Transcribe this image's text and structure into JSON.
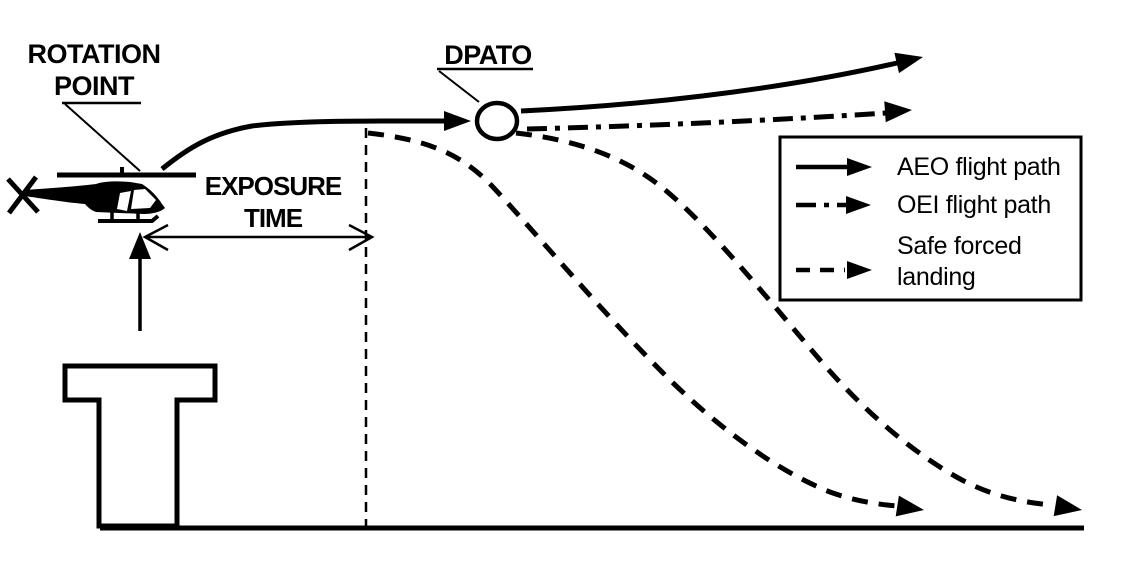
{
  "diagram_labels": {
    "rotation_point_line1": "ROTATION",
    "rotation_point_line2": "POINT",
    "dpato": "DPATO",
    "exposure_line1": "EXPOSURE",
    "exposure_line2": "TIME"
  },
  "legend": {
    "items": [
      {
        "label": "AEO flight path",
        "line_style": "solid-arrow"
      },
      {
        "label": "OEI flight path",
        "line_style": "dash-dot-arrow"
      },
      {
        "label": "Safe forced landing",
        "line_style": "dashed-arrow"
      }
    ]
  },
  "colors": {
    "ink": "#000000",
    "paper": "#ffffff"
  }
}
